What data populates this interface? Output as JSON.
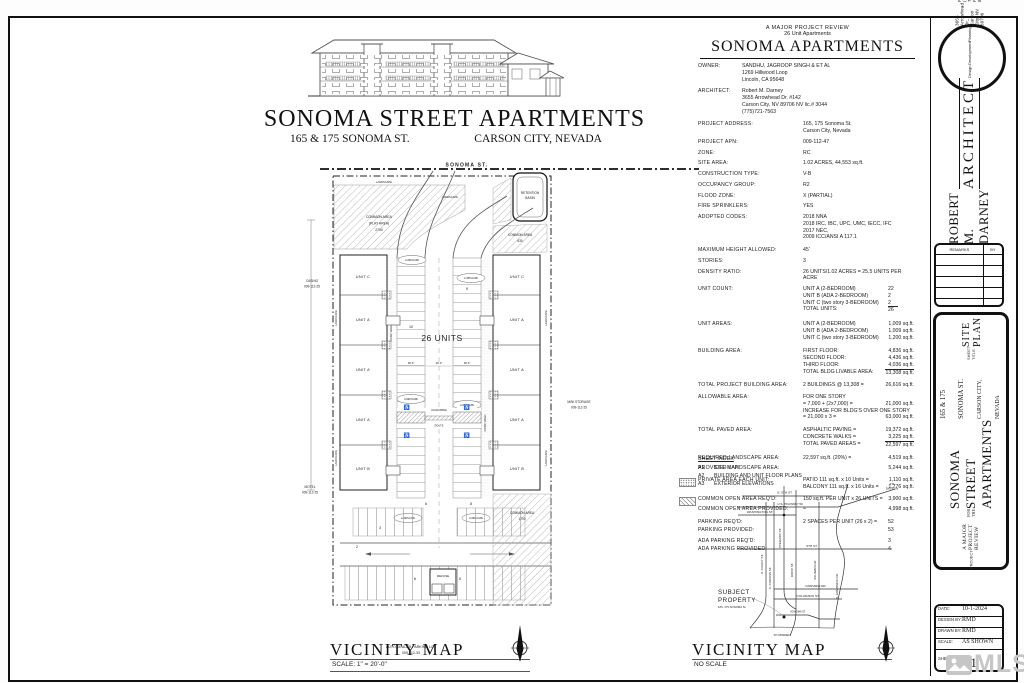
{
  "sheet": {
    "header": {
      "line1": "A MAJOR PROJECT REVIEW",
      "line2": "26 Unit Apartments",
      "title": "SONOMA APARTMENTS"
    },
    "main_title": {
      "title": "SONOMA STREET APARTMENTS",
      "subtitle_left": "165 & 175 SONOMA ST.",
      "subtitle_right": "CARSON CITY, NEVADA"
    }
  },
  "specs": {
    "rows": [
      {
        "label": "OWNER:",
        "lw": 44,
        "lines": [
          {
            "t": "SANDHU, JAGROOP SINGH & ET AL"
          },
          {
            "t": "1269 Hillwood Loop"
          },
          {
            "t": "Lincoln, CA  95648"
          }
        ]
      },
      {
        "label": "ARCHITECT:",
        "lw": 44,
        "mt": 5,
        "lines": [
          {
            "t": "Robert M. Darney"
          },
          {
            "t": "3655 Arrowhead Dr. #142"
          },
          {
            "t": "Carson City, NV  89706      NV lic.# 3044"
          },
          {
            "t": "(775)721-7563"
          }
        ]
      },
      {
        "label": "PROJECT ADDRESS:",
        "mt": 6,
        "lines": [
          {
            "t": "165, 175 Sonoma St."
          },
          {
            "t": "Carson City, Nevada"
          }
        ]
      },
      {
        "label": "PROJECT APN:",
        "mt": 4,
        "lines": [
          {
            "t": "009-112-47"
          }
        ]
      },
      {
        "label": "ZONE:",
        "mt": 4,
        "lines": [
          {
            "t": "RC"
          }
        ]
      },
      {
        "label": "SITE AREA:",
        "mt": 4,
        "lines": [
          {
            "t": "1.02 ACRES, 44,553 sq.ft."
          }
        ]
      },
      {
        "label": "CONSTRUCTION TYPE:",
        "mt": 4,
        "lines": [
          {
            "t": "V-B"
          }
        ]
      },
      {
        "label": "OCCUPANCY GROUP:",
        "mt": 4,
        "lines": [
          {
            "t": "R2"
          }
        ]
      },
      {
        "label": "FLOOD ZONE:",
        "mt": 4,
        "lines": [
          {
            "t": "X (PARTIAL)"
          }
        ]
      },
      {
        "label": "FIRE SPRINKLERS:",
        "mt": 4,
        "lines": [
          {
            "t": "YES"
          }
        ]
      },
      {
        "label": "ADOPTED CODES:",
        "mt": 4,
        "lines": [
          {
            "t": "2018 NNA"
          },
          {
            "t": "2018 IRC, IBC, UPC, UMC, IECC, IFC"
          },
          {
            "t": "2017 NEC,"
          },
          {
            "t": "2009 ICC/ANSI A 117.1"
          }
        ]
      },
      {
        "label": "MAXIMUM HEIGHT ALLOWED:",
        "mt": 6,
        "lines": [
          {
            "t": "45'"
          }
        ]
      },
      {
        "label": "STORIES:",
        "mt": 4,
        "lines": [
          {
            "t": "3"
          }
        ]
      },
      {
        "label": "DENSITY RATIO:",
        "mt": 4,
        "lines": [
          {
            "t": "26 UNITS/1.02 ACRES  =  25.5 UNITS PER ACRE"
          }
        ]
      },
      {
        "label": "UNIT COUNT:",
        "mt": 4,
        "lines": [
          {
            "t": "UNIT A (2-BEDROOM)",
            "v": "22"
          },
          {
            "t": "UNIT B (ADA 2-BEDROOM)",
            "v": "2"
          },
          {
            "t": "UNIT C (two story 3-BEDROOM)",
            "v": "2"
          },
          {
            "t": "TOTAL UNITS:",
            "v": "26",
            "ul": true
          }
        ]
      },
      {
        "label": "UNIT AREAS:",
        "mt": 7,
        "lines": [
          {
            "t": "UNIT A (2-BEDROOM)",
            "v": "1,009 sq.ft."
          },
          {
            "t": "UNIT B (ADA 2-BEDROOM)",
            "v": "1,009 sq.ft."
          },
          {
            "t": "UNIT C (two story 3-BEDROOM)",
            "v": "1,200 sq.ft."
          }
        ]
      },
      {
        "label": "BUILDING AREA:",
        "mt": 7,
        "lines": [
          {
            "t": "FIRST FLOOR:",
            "v": "4,836 sq.ft."
          },
          {
            "t": "SECOND FLOOR:",
            "v": "4,436 sq.ft."
          },
          {
            "t": "THIRD FLOOR:",
            "v": "4,036 sq.ft."
          },
          {
            "t": "TOTAL BLDG LIVABLE AREA:",
            "v": "13,308 sq.ft.",
            "ul": true
          }
        ]
      },
      {
        "label": "TOTAL PROJECT BUILDING AREA:",
        "mt": 6,
        "lines": [
          {
            "t": "2 BUILDINGS @ 13,308 =",
            "v": "26,616 sq.ft."
          }
        ]
      },
      {
        "label": "ALLOWABLE AREA:",
        "mt": 5,
        "lines": [
          {
            "t": "FOR ONE STORY"
          },
          {
            "t": "= 7,000 + (2x7,000) =",
            "v": "21,000 sq.ft."
          },
          {
            "t": "INCREASE FOR BLDG'S OVER ONE STORY"
          },
          {
            "t": "= 21,000 x 3 =",
            "v": "63,000 sq.ft."
          }
        ]
      },
      {
        "label": "TOTAL PAVED AREA:",
        "mt": 6,
        "lines": [
          {
            "t": "ASPHALTIC PAVING =",
            "v": "19,372 sq.ft."
          },
          {
            "t": "CONCRETE WALKS =",
            "v": "3,225 sq.ft."
          },
          {
            "t": "TOTAL PAVED AREAS =",
            "v": "22,597 sq.ft.",
            "ul": true
          }
        ]
      },
      {
        "label": "REQUIRED LANDSCAPE AREA:",
        "mt": 7,
        "lines": [
          {
            "t": "22,597 sq.ft. (20%) =",
            "v": "4,519 sq.ft."
          }
        ]
      },
      {
        "label": "PROVIDED LANDSCAPE AREA:",
        "mt": 3,
        "lines": [
          {
            "t": "",
            "v": "5,244 sq.ft."
          }
        ]
      },
      {
        "label": "PRIVATE AREA EACH UNIT:",
        "mt": 5,
        "swatch": "dots",
        "lines": [
          {
            "t": "PATIO 111 sq.ft. x 10 Units =",
            "v": "1,110 sq.ft."
          },
          {
            "t": "BALCONY 111 sq.ft. x 16 Units =",
            "v": "1,776 sq.ft."
          }
        ]
      },
      {
        "label": "COMMON OPEN AREA REQ'D:",
        "mt": 6,
        "swatch": "hatch",
        "lines": [
          {
            "t": "150 sq.ft. PER UNIT x 26 UNITS  =",
            "v": "3,900 sq.ft."
          }
        ]
      },
      {
        "label": "COMMON OPEN AREA PROVIDED:",
        "mt": 3,
        "lines": [
          {
            "t": "=",
            "v": "4,998 sq.ft."
          }
        ]
      },
      {
        "label": "PARKING REQ'D:",
        "mt": 6,
        "lines": [
          {
            "t": "2 SPACES PER UNIT (26 x 2)  =",
            "v": "52"
          }
        ]
      },
      {
        "label": "PARKING PROVIDED:",
        "mt": 1,
        "lines": [
          {
            "t": "",
            "v": "53"
          }
        ]
      },
      {
        "label": "ADA PARKING REQ'D:",
        "mt": 5,
        "lines": [
          {
            "t": "",
            "v": "3"
          }
        ]
      },
      {
        "label": "ADA PARKING PROVIDED:",
        "mt": 1,
        "lines": [
          {
            "t": "",
            "v": "4"
          }
        ]
      }
    ]
  },
  "sheet_index": {
    "heading": "SHEET INDEX",
    "rows": [
      {
        "num": "A1",
        "title": "SITE MAP"
      },
      {
        "num": "A2",
        "title": "BUILDING AND UNIT FLOOR PLANS"
      },
      {
        "num": "A3",
        "title": "EXTERIOR ELEVATIONS"
      }
    ]
  },
  "site_plan": {
    "street": "SONOMA ST.",
    "units_count_label": "26 UNITS",
    "units_left": [
      "UNIT C",
      "UNIT A",
      "UNIT A",
      "UNIT A",
      "UNIT B"
    ],
    "units_right": [
      "UNIT C",
      "UNIT A",
      "UNIT A",
      "UNIT A",
      "UNIT B"
    ],
    "landscape": "LANDSCAPE",
    "conc_walk": "CONC WALK",
    "accessible": [
      "ACCESSIBLE",
      "ROUTE"
    ],
    "ada_icon": "♿",
    "refuse": "REFUSE",
    "common_play": [
      "COMMON AREA",
      "(PLAY AREA)",
      "2700"
    ],
    "retention": [
      "RETENTION",
      "BASIN"
    ],
    "common_right": [
      "COMMON AREA",
      "630"
    ],
    "common_bottom": [
      "COMMON AREA",
      "1700"
    ],
    "casino": [
      "CASINO",
      "009-112-25"
    ],
    "motel": [
      "MOTEL",
      "009-112-25"
    ],
    "mini_storage": [
      "MINI STORAGE",
      "009-112-25"
    ],
    "auto_dealer": [
      "AUTO DEALER PARKING LOT",
      "009-112-33"
    ],
    "counts": [
      "10",
      "9",
      "8",
      "6",
      "3",
      "2",
      "6",
      "5"
    ],
    "dims": [
      "18'-6\"",
      "26'-0\"",
      "18'-6\""
    ],
    "map_title": "VICINITY MAP",
    "map_scale": "SCALE:  1\"  =  20'-0\""
  },
  "vicinity": {
    "title": "VICINITY MAP",
    "scale": "NO SCALE",
    "streets": {
      "e5th": "E. 5TH ST.",
      "hwy50": "U.S. HIGHWAY 50",
      "washington": "WASHINGTON ST.",
      "fifth": "5TH ST.",
      "fairview": "FAIRVIEW DR.",
      "colorado": "COLORADO ST.",
      "sonoma": "SONOMA ST.",
      "curry": "S. CURRY ST.",
      "carson": "S. CARSON ST.",
      "stewart": "STEWART ST.",
      "roop": "ROOP ST.",
      "saliman": "SALIMAN RD.",
      "edmonds": "S. EDMONDS DR."
    },
    "subject": [
      "SUBJECT",
      "PROPERTY",
      "165, 175 SONOMA St."
    ],
    "to_dayton": [
      "TO",
      "DAYTON"
    ],
    "to_minden": "TO MINDEN"
  },
  "titleblock": {
    "architect": {
      "name": "ROBERT M. DARNEY",
      "profession": "ARCHITECT",
      "tagline": [
        "Design",
        "Development",
        "Planning"
      ],
      "address": "3655 Arrowhead Dr., Carson City, NV 89706",
      "phone_fax": "PHONE: (775)721-7563    FAX: 882-9430",
      "email": "E-MAIL:  darneyarchitect@global.net"
    },
    "remarks": {
      "col1": "REMARKS",
      "col2": "BY"
    },
    "project": {
      "review_line": "A  MAJOR  PROJECT  REVIEW",
      "for_the": "FOR THE",
      "title": "SONOMA STREET APARTMENTS",
      "address": "165 & 175 SONOMA ST.",
      "city": "CARSON CITY, NEVADA",
      "project_label": "PROJECT",
      "sheet_title_label": "SHEET TITLE",
      "sheet_name": "SITE PLAN"
    },
    "info": {
      "date_label": "DATE:",
      "date": "10-1-2024",
      "design_label": "DESIGN BY:",
      "design": "RMD",
      "drawn_label": "DRAWN BY:",
      "drawn": "RMD",
      "scale_label": "SCALE:",
      "scale": "AS SHOWN",
      "sheet_label": "SHEET No.",
      "sheet": "A1"
    }
  },
  "watermark": {
    "text": "MLS"
  }
}
